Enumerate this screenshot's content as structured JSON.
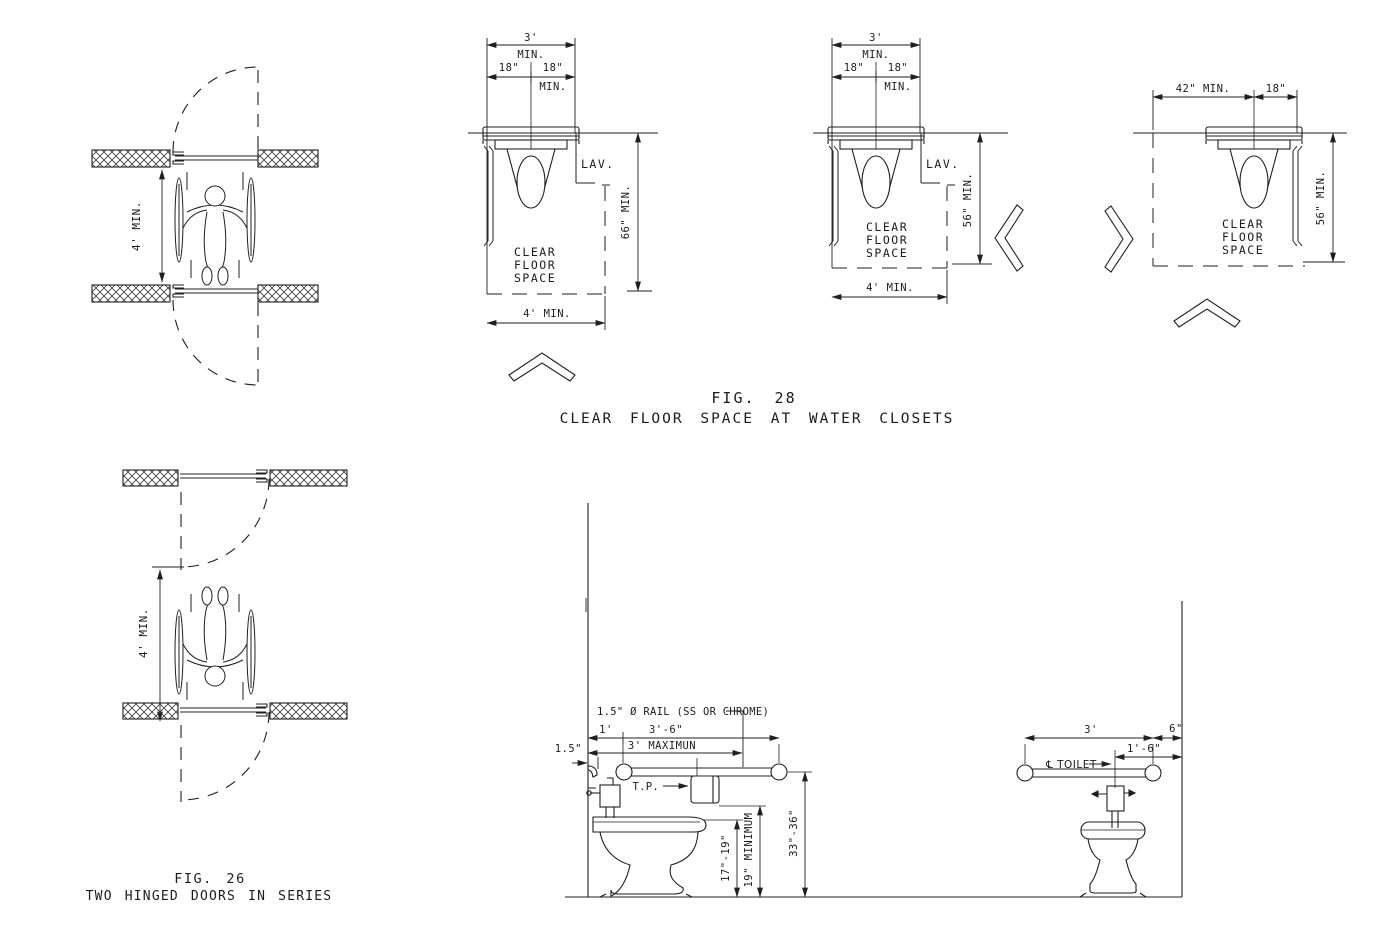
{
  "fig28": {
    "caption_fig": "FIG. 28",
    "caption_title": "CLEAR FLOOR SPACE AT WATER CLOSETS",
    "d1": {
      "width_total": "3'",
      "width_total_min": "MIN.",
      "half_left": "18\"",
      "half_right": "18\"",
      "half_min": "MIN.",
      "lav": "LAV.",
      "cfs1": "CLEAR",
      "cfs2": "FLOOR",
      "cfs3": "SPACE",
      "depth": "66\" MIN.",
      "width_bottom": "4' MIN."
    },
    "d2": {
      "width_total": "3'",
      "width_total_min": "MIN.",
      "half_left": "18\"",
      "half_right": "18\"",
      "half_min": "MIN.",
      "lav": "LAV.",
      "cfs1": "CLEAR",
      "cfs2": "FLOOR",
      "cfs3": "SPACE",
      "depth": "56\" MIN.",
      "width_bottom": "4' MIN."
    },
    "d3": {
      "width_left": "42\" MIN.",
      "width_right": "18\"",
      "cfs1": "CLEAR",
      "cfs2": "FLOOR",
      "cfs3": "SPACE",
      "depth": "56\" MIN."
    }
  },
  "fig26": {
    "caption_fig": "FIG. 26",
    "caption_title": "TWO HINGED DOORS IN SERIES",
    "top_dim": "4' MIN.",
    "bottom_dim": "4' MIN."
  },
  "side_elevation": {
    "rail_note": "1.5\" Ø RAIL (SS OR CHROME)",
    "dim_1ft": "1'",
    "dim_3ft6": "3'-6\"",
    "dim_3max": "3' MAXIMUN",
    "dim_gap": "1.5\"",
    "tp": "T.P.",
    "seat_height": "17\"-19\"",
    "tp_height": "19\" MINIMUM",
    "rail_height": "33\"-36\""
  },
  "rear_elevation": {
    "dim_3ft": "3'",
    "dim_6in": "6\"",
    "dim_1ft6": "1'-6\"",
    "cl_toilet": "℄ TOILET"
  },
  "colors": {
    "line": "#1f1f1f",
    "background": "#ffffff"
  }
}
